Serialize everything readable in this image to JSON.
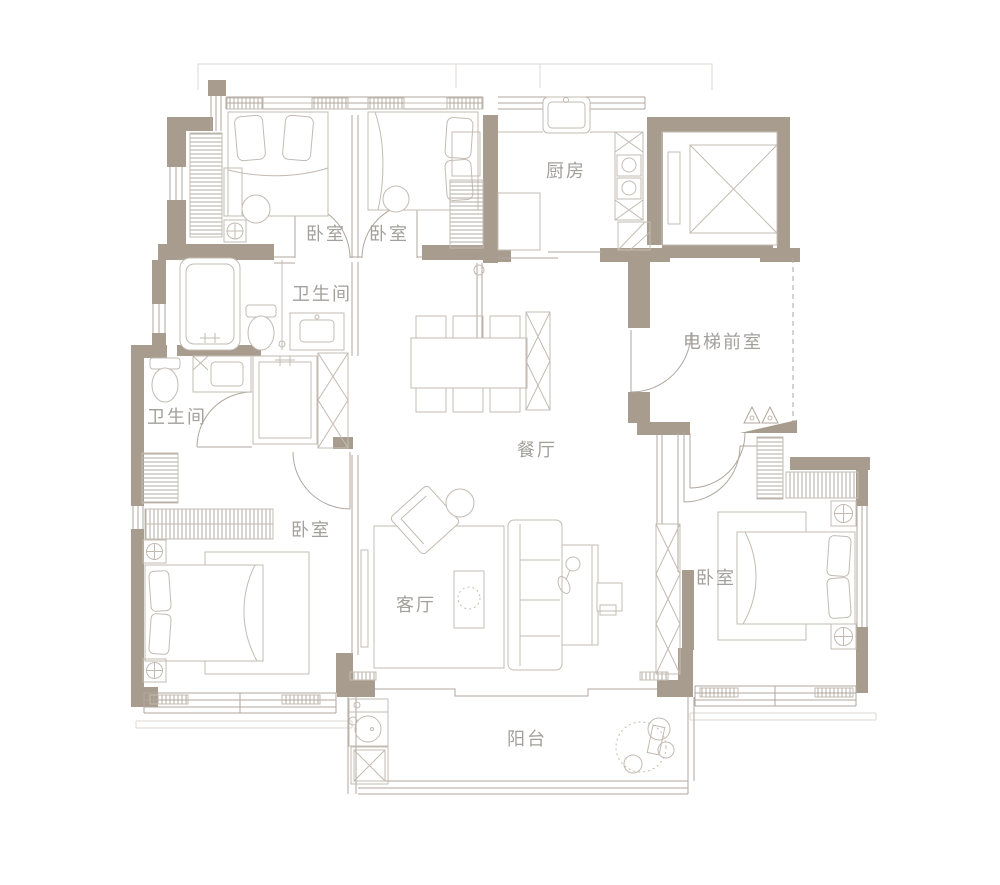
{
  "colors": {
    "wall": "#a89c8e",
    "thin_line": "#b0a79e",
    "furniture_line": "#c3bbb2",
    "faint_line": "#ddd7d0",
    "label_text": "#a39f9b",
    "background": "#ffffff"
  },
  "rooms": [
    {
      "id": "bedroom-top-left",
      "label": "卧室"
    },
    {
      "id": "bedroom-top-middle",
      "label": "卧室"
    },
    {
      "id": "kitchen",
      "label": "厨房"
    },
    {
      "id": "bathroom-upper",
      "label": "卫生间"
    },
    {
      "id": "elevator-vestibule",
      "label": "电梯前室"
    },
    {
      "id": "bathroom-lower",
      "label": "卫生间"
    },
    {
      "id": "dining-room",
      "label": "餐厅"
    },
    {
      "id": "bedroom-left",
      "label": "卧室"
    },
    {
      "id": "living-room",
      "label": "客厅"
    },
    {
      "id": "bedroom-right",
      "label": "卧室"
    },
    {
      "id": "balcony",
      "label": "阳台"
    }
  ]
}
